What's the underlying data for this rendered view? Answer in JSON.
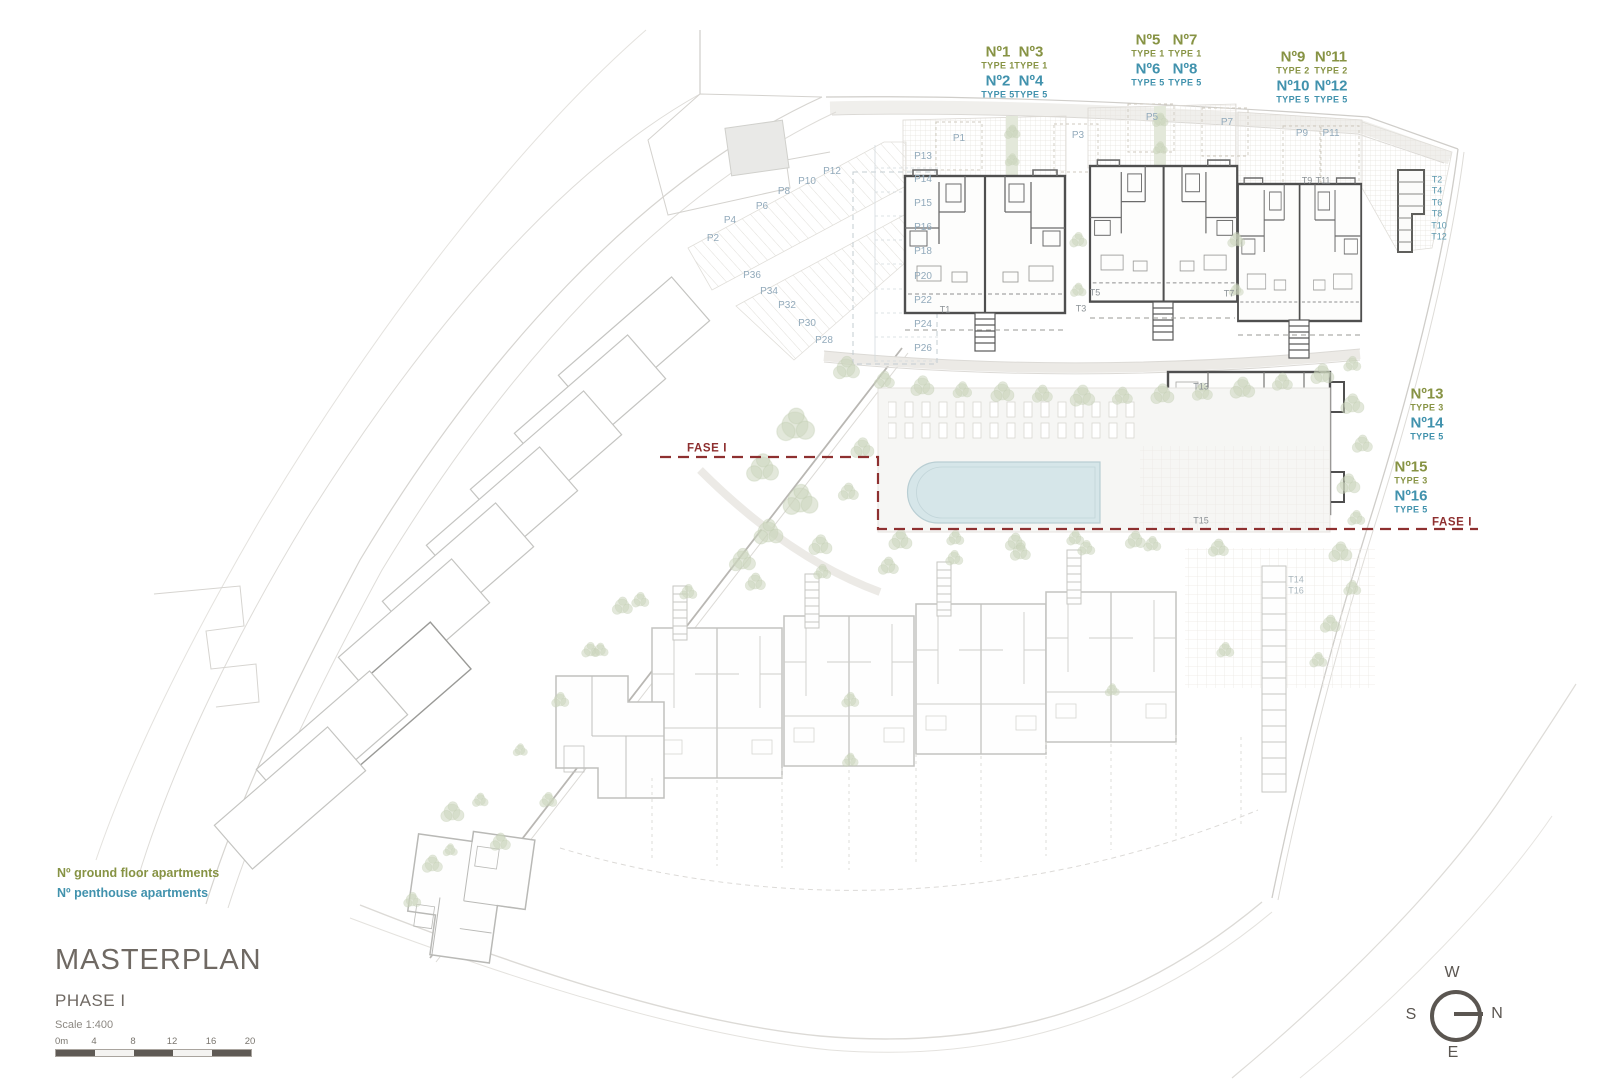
{
  "legend": {
    "ground_floor": "Nº ground floor apartments",
    "penthouse": "Nº penthouse apartments"
  },
  "title_block": {
    "title": "MASTERPLAN",
    "phase": "PHASE I",
    "scale": "Scale 1:400"
  },
  "scale_bar": {
    "ticks": [
      "0m",
      "4",
      "8",
      "12",
      "16",
      "20"
    ]
  },
  "compass": {
    "top": "W",
    "left": "S",
    "right": "N",
    "bottom": "E"
  },
  "colors": {
    "ground_floor_label": "#879344",
    "penthouse_label": "#4192ad",
    "parking_label": "#92aabb",
    "phase_boundary": "#8e2f2f",
    "title_text": "#6f6963",
    "plan_dark_line": "#4f4f4f",
    "plan_light_line": "#c6c6c2",
    "tree_green": "#ccd6bd",
    "pool_blue": "#d6e6e9"
  },
  "plan_labels": [
    {
      "kind": "g",
      "text": "Nº1",
      "x": 998,
      "y": 52
    },
    {
      "kind": "g",
      "text": "Nº3",
      "x": 1031,
      "y": 52
    },
    {
      "kind": "gs",
      "text": "TYPE 1",
      "x": 998,
      "y": 66
    },
    {
      "kind": "gs",
      "text": "TYPE 1",
      "x": 1031,
      "y": 66
    },
    {
      "kind": "p",
      "text": "Nº2",
      "x": 998,
      "y": 81
    },
    {
      "kind": "p",
      "text": "Nº4",
      "x": 1031,
      "y": 81
    },
    {
      "kind": "ps",
      "text": "TYPE 5",
      "x": 998,
      "y": 95
    },
    {
      "kind": "ps",
      "text": "TYPE 5",
      "x": 1031,
      "y": 95
    },
    {
      "kind": "g",
      "text": "Nº5",
      "x": 1148,
      "y": 40
    },
    {
      "kind": "g",
      "text": "Nº7",
      "x": 1185,
      "y": 40
    },
    {
      "kind": "gs",
      "text": "TYPE 1",
      "x": 1148,
      "y": 54
    },
    {
      "kind": "gs",
      "text": "TYPE 1",
      "x": 1185,
      "y": 54
    },
    {
      "kind": "p",
      "text": "Nº6",
      "x": 1148,
      "y": 69
    },
    {
      "kind": "p",
      "text": "Nº8",
      "x": 1185,
      "y": 69
    },
    {
      "kind": "ps",
      "text": "TYPE 5",
      "x": 1148,
      "y": 83
    },
    {
      "kind": "ps",
      "text": "TYPE 5",
      "x": 1185,
      "y": 83
    },
    {
      "kind": "g",
      "text": "Nº9",
      "x": 1293,
      "y": 57
    },
    {
      "kind": "g",
      "text": "Nº11",
      "x": 1331,
      "y": 57
    },
    {
      "kind": "gs",
      "text": "TYPE 2",
      "x": 1293,
      "y": 71
    },
    {
      "kind": "gs",
      "text": "TYPE 2",
      "x": 1331,
      "y": 71
    },
    {
      "kind": "p",
      "text": "Nº10",
      "x": 1293,
      "y": 86
    },
    {
      "kind": "p",
      "text": "Nº12",
      "x": 1331,
      "y": 86
    },
    {
      "kind": "ps",
      "text": "TYPE 5",
      "x": 1293,
      "y": 100
    },
    {
      "kind": "ps",
      "text": "TYPE 5",
      "x": 1331,
      "y": 100
    },
    {
      "kind": "g",
      "text": "Nº13",
      "x": 1427,
      "y": 394
    },
    {
      "kind": "gs",
      "text": "TYPE 3",
      "x": 1427,
      "y": 408
    },
    {
      "kind": "p",
      "text": "Nº14",
      "x": 1427,
      "y": 423
    },
    {
      "kind": "ps",
      "text": "TYPE 5",
      "x": 1427,
      "y": 437
    },
    {
      "kind": "g",
      "text": "Nº15",
      "x": 1411,
      "y": 467
    },
    {
      "kind": "gs",
      "text": "TYPE 3",
      "x": 1411,
      "y": 481
    },
    {
      "kind": "p",
      "text": "Nº16",
      "x": 1411,
      "y": 496
    },
    {
      "kind": "ps",
      "text": "TYPE 5",
      "x": 1411,
      "y": 510
    },
    {
      "kind": "park",
      "text": "P1",
      "x": 959,
      "y": 139
    },
    {
      "kind": "park",
      "text": "P3",
      "x": 1078,
      "y": 136
    },
    {
      "kind": "park",
      "text": "P5",
      "x": 1152,
      "y": 118
    },
    {
      "kind": "park",
      "text": "P7",
      "x": 1227,
      "y": 123
    },
    {
      "kind": "park",
      "text": "P9",
      "x": 1302,
      "y": 134
    },
    {
      "kind": "park",
      "text": "P11",
      "x": 1331,
      "y": 134
    },
    {
      "kind": "park",
      "text": "P13",
      "x": 923,
      "y": 157
    },
    {
      "kind": "park",
      "text": "P14",
      "x": 923,
      "y": 180
    },
    {
      "kind": "park",
      "text": "P15",
      "x": 923,
      "y": 204
    },
    {
      "kind": "park",
      "text": "P16",
      "x": 923,
      "y": 228
    },
    {
      "kind": "park",
      "text": "P18",
      "x": 923,
      "y": 252
    },
    {
      "kind": "park",
      "text": "P20",
      "x": 923,
      "y": 277
    },
    {
      "kind": "park",
      "text": "P22",
      "x": 923,
      "y": 301
    },
    {
      "kind": "park",
      "text": "P24",
      "x": 923,
      "y": 325
    },
    {
      "kind": "park",
      "text": "P26",
      "x": 923,
      "y": 349
    },
    {
      "kind": "park",
      "text": "P12",
      "x": 832,
      "y": 172
    },
    {
      "kind": "park",
      "text": "P10",
      "x": 807,
      "y": 182
    },
    {
      "kind": "park",
      "text": "P8",
      "x": 784,
      "y": 192
    },
    {
      "kind": "park",
      "text": "P6",
      "x": 762,
      "y": 207
    },
    {
      "kind": "park",
      "text": "P4",
      "x": 730,
      "y": 221
    },
    {
      "kind": "park",
      "text": "P2",
      "x": 713,
      "y": 239
    },
    {
      "kind": "park",
      "text": "P36",
      "x": 752,
      "y": 276
    },
    {
      "kind": "park",
      "text": "P34",
      "x": 769,
      "y": 292
    },
    {
      "kind": "park",
      "text": "P32",
      "x": 787,
      "y": 306
    },
    {
      "kind": "park",
      "text": "P30",
      "x": 807,
      "y": 324
    },
    {
      "kind": "park",
      "text": "P28",
      "x": 824,
      "y": 341
    },
    {
      "kind": "st",
      "text": "T1",
      "x": 945,
      "y": 310
    },
    {
      "kind": "st",
      "text": "T3",
      "x": 1081,
      "y": 309
    },
    {
      "kind": "st",
      "text": "T5",
      "x": 1095,
      "y": 293
    },
    {
      "kind": "st",
      "text": "T7",
      "x": 1229,
      "y": 294
    },
    {
      "kind": "st",
      "text": "T9",
      "x": 1307,
      "y": 181
    },
    {
      "kind": "st",
      "text": "T11",
      "x": 1323,
      "y": 181
    },
    {
      "kind": "stb",
      "text": "T2",
      "x": 1437,
      "y": 180
    },
    {
      "kind": "stb",
      "text": "T4",
      "x": 1437,
      "y": 191
    },
    {
      "kind": "stb",
      "text": "T6",
      "x": 1437,
      "y": 203
    },
    {
      "kind": "stb",
      "text": "T8",
      "x": 1437,
      "y": 214
    },
    {
      "kind": "stb",
      "text": "T10",
      "x": 1439,
      "y": 226
    },
    {
      "kind": "stb",
      "text": "T12",
      "x": 1439,
      "y": 237
    },
    {
      "kind": "st",
      "text": "T13",
      "x": 1201,
      "y": 387
    },
    {
      "kind": "st",
      "text": "T15",
      "x": 1201,
      "y": 521
    },
    {
      "kind": "stl",
      "text": "T14",
      "x": 1296,
      "y": 580
    },
    {
      "kind": "stl",
      "text": "T16",
      "x": 1296,
      "y": 591
    },
    {
      "kind": "fase",
      "text": "FASE I",
      "x": 707,
      "y": 449
    },
    {
      "kind": "fase",
      "text": "FASE I",
      "x": 1452,
      "y": 523
    }
  ]
}
